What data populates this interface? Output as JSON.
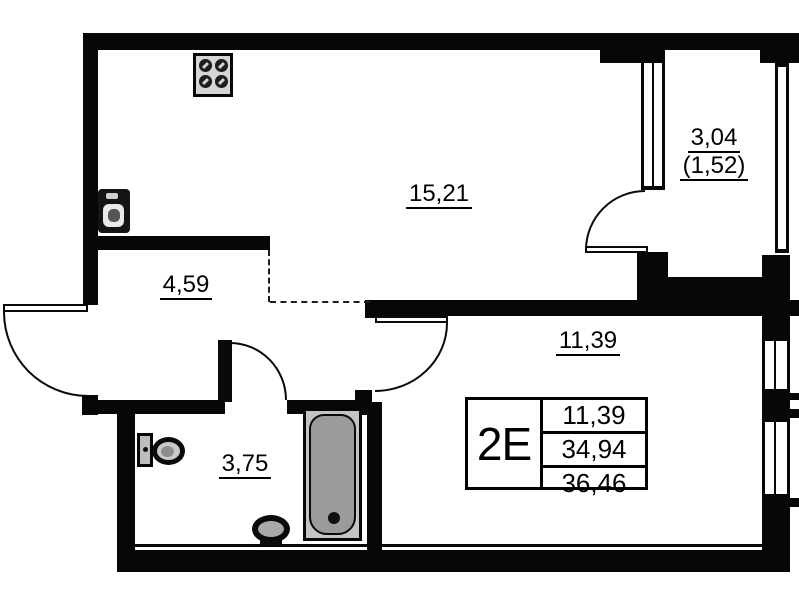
{
  "plan": {
    "rooms": {
      "kitchen_living": {
        "area": "15,21"
      },
      "hallway": {
        "area": "4,59"
      },
      "bathroom": {
        "area": "3,75"
      },
      "bedroom": {
        "area": "11,39"
      },
      "balcony": {
        "area": "3,04",
        "area_coef": "(1,52)"
      }
    },
    "info_box": {
      "type": "2E",
      "living_area": "11,39",
      "area_no_balcony": "34,94",
      "total_area": "36,46"
    },
    "fixtures": {
      "kitchen": [
        "stove-icon",
        "kitchen-sink-icon"
      ],
      "bathroom": [
        "toilet-icon",
        "washbasin-icon",
        "bathtub-icon"
      ]
    },
    "colors": {
      "wall": "#070707",
      "background": "#ffffff",
      "fixture_gray": "#9b9b9b",
      "tub_rim_gray": "#c4c4c4"
    }
  }
}
